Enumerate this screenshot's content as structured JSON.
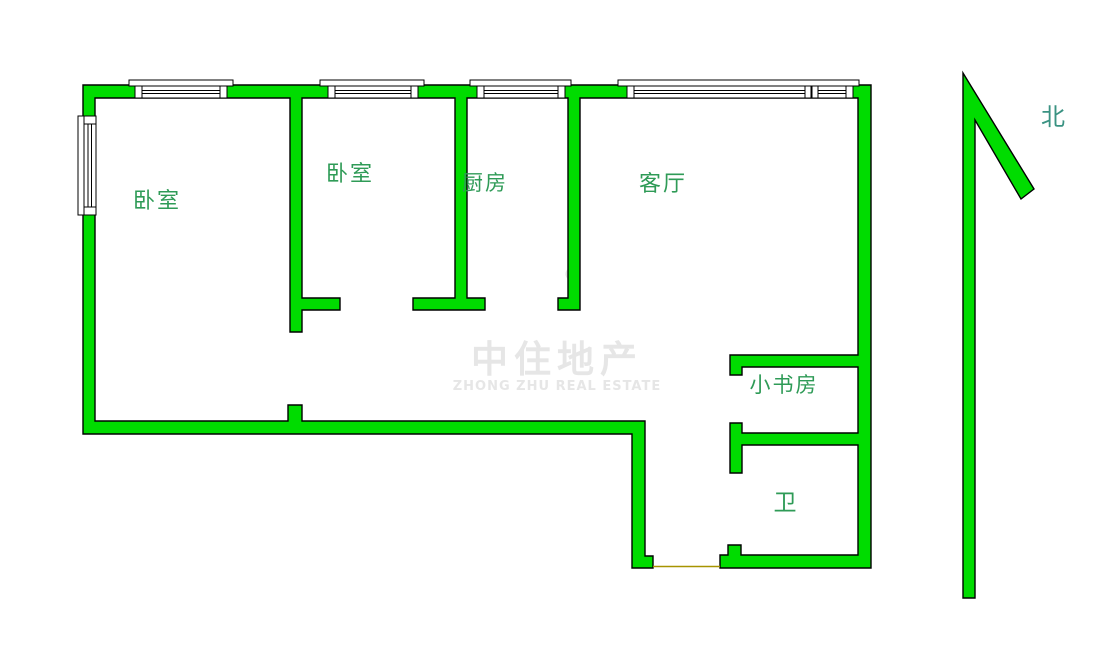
{
  "plan": {
    "rooms": [
      {
        "id": "bedroom-1",
        "label": "卧室"
      },
      {
        "id": "bedroom-2",
        "label": "卧室"
      },
      {
        "id": "kitchen",
        "label": "厨房"
      },
      {
        "id": "living-room",
        "label": "客厅"
      },
      {
        "id": "study",
        "label": "小书房"
      },
      {
        "id": "bathroom",
        "label": "卫"
      }
    ],
    "compass": {
      "label": "北",
      "direction": "north"
    }
  },
  "watermark": {
    "title": "中住地产",
    "subtitle": "ZHONG ZHU REAL ESTATE"
  },
  "colors": {
    "wall-fill": "#00dc00",
    "wall-outline": "#000000",
    "room-label": "#2f9b57",
    "north-label": "#3a9282",
    "watermark-text": "#e6e6e6",
    "threshold": "#a79400",
    "window-fill": "#ffffff"
  }
}
